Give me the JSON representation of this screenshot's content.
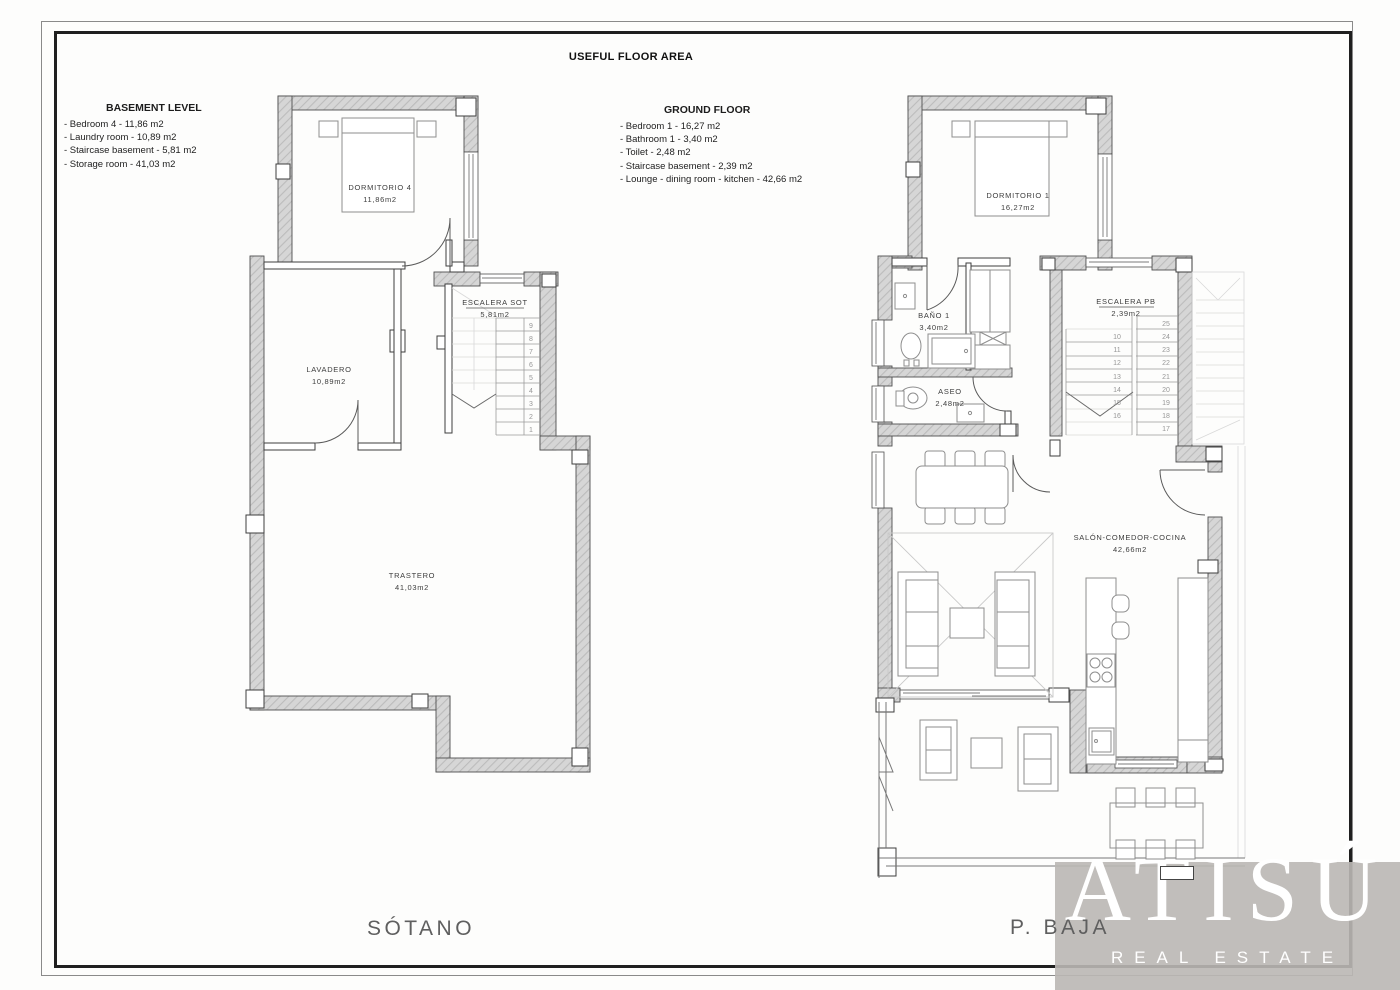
{
  "page": {
    "title": "USEFUL FLOOR AREA"
  },
  "legend_basement": {
    "title": "BASEMENT LEVEL",
    "items": [
      "- Bedroom 4 - 11,86 m2",
      "- Laundry room - 10,89 m2",
      "- Staircase basement - 5,81 m2",
      "- Storage room - 41,03 m2"
    ]
  },
  "legend_ground": {
    "title": "GROUND FLOOR",
    "items": [
      "- Bedroom 1 - 16,27 m2",
      "- Bathroom 1 - 3,40 m2",
      "- Toilet - 2,48 m2",
      "- Staircase basement - 2,39 m2",
      "- Lounge - dining room - kitchen - 42,66 m2"
    ]
  },
  "basement": {
    "floor_label": "SÓTANO",
    "rooms": {
      "dormitorio4": {
        "name": "DORMITORIO 4",
        "area": "11,86m2"
      },
      "lavadero": {
        "name": "LAVADERO",
        "area": "10,89m2"
      },
      "escalera": {
        "name": "ESCALERA SOT",
        "area": "5,81m2"
      },
      "trastero": {
        "name": "TRASTERO",
        "area": "41,03m2"
      }
    },
    "stair_numbers": [
      "9",
      "8",
      "7",
      "6",
      "5",
      "4",
      "3",
      "2",
      "1"
    ]
  },
  "ground": {
    "floor_label": "P. BAJA",
    "rooms": {
      "dormitorio1": {
        "name": "DORMITORIO 1",
        "area": "16,27m2"
      },
      "bano": {
        "name": "BAÑO 1",
        "area": "3,40m2"
      },
      "aseo": {
        "name": "ASEO",
        "area": "2,48m2"
      },
      "escalera": {
        "name": "ESCALERA PB",
        "area": "2,39m2"
      },
      "salon": {
        "name": "SALÓN-COMEDOR-COCINA",
        "area": "42,66m2"
      }
    },
    "stair_numbers_left": [
      "10",
      "11",
      "12",
      "13",
      "14",
      "15",
      "16"
    ],
    "stair_numbers_right": [
      "25",
      "24",
      "23",
      "22",
      "21",
      "20",
      "19",
      "18",
      "17"
    ]
  },
  "watermark": {
    "brand": "ATISÚ",
    "tagline": "REAL ESTATE"
  },
  "colors": {
    "wall_fill": "#d6d6d6",
    "wall_hatch": "#bcbcbc",
    "watermark_bg": "#bab7b4",
    "line": "#4f4f4f"
  }
}
